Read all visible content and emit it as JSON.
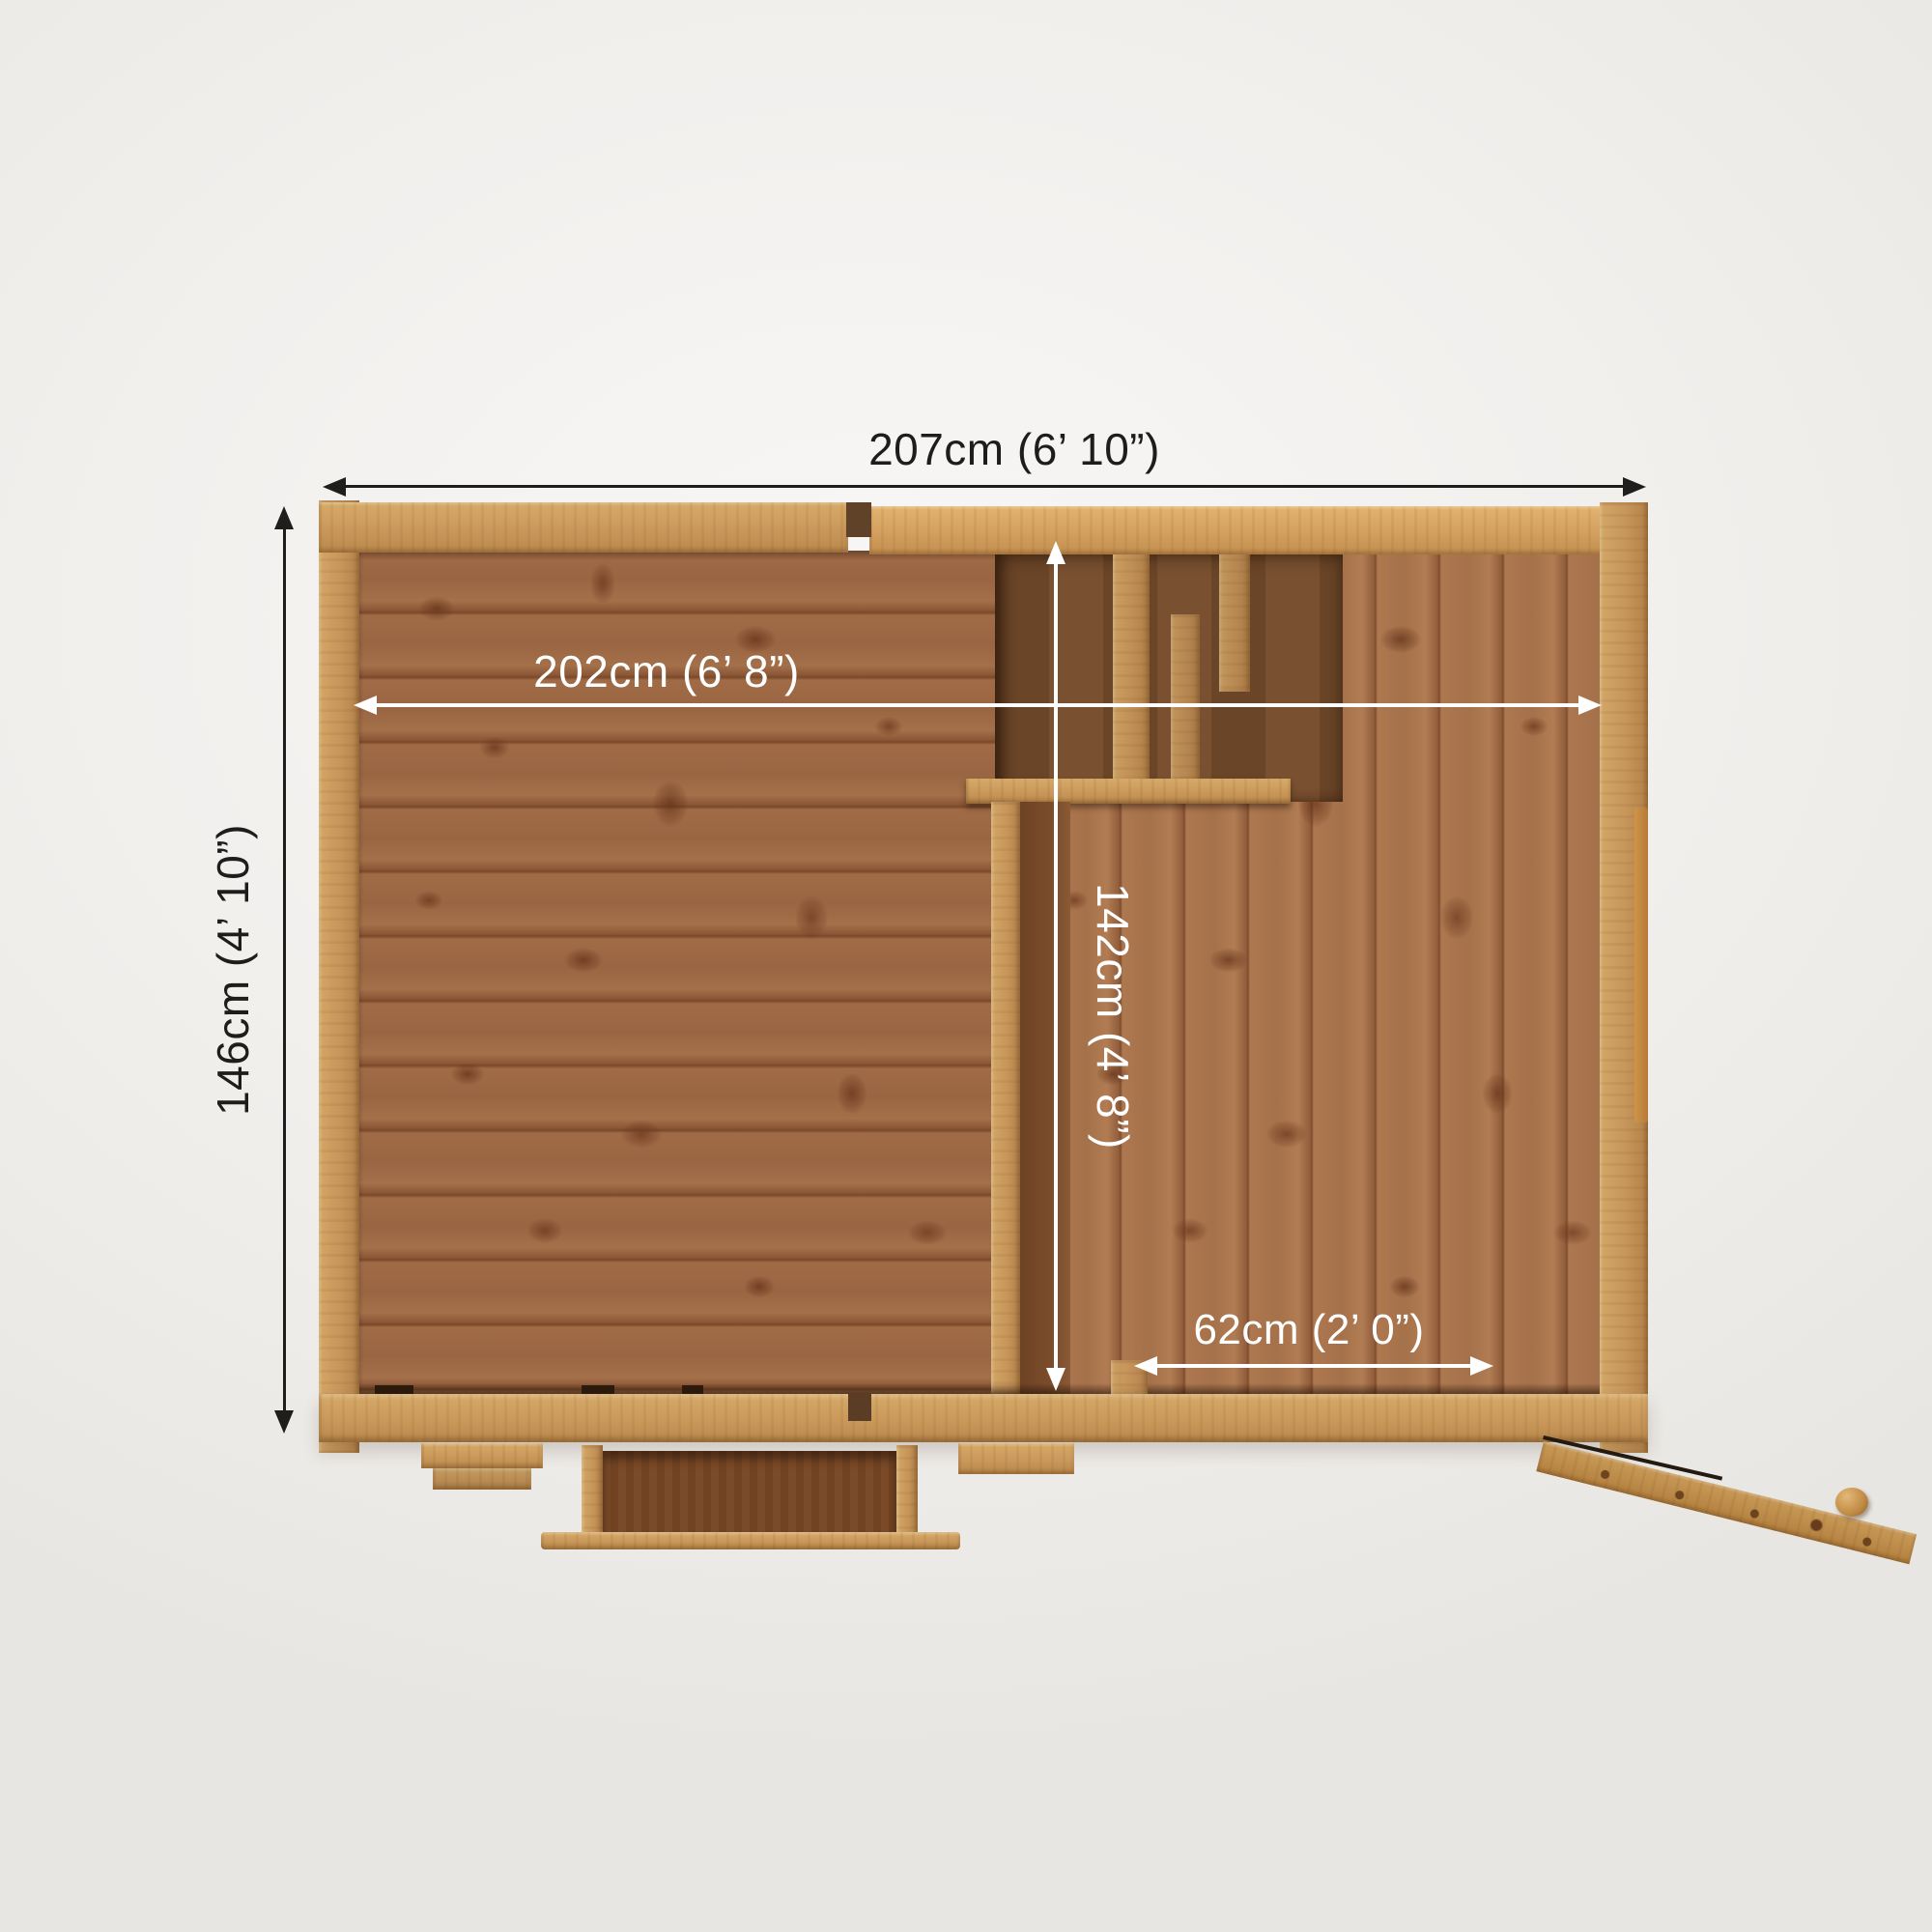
{
  "diagram": {
    "type": "shed-top-view-floor-plan",
    "dimensions": {
      "overall_width": "207cm (6’ 10”)",
      "overall_depth": "146cm (4’ 10”)",
      "internal_width": "202cm (6’ 8”)",
      "internal_depth": "142cm (4’ 8”)",
      "side_storage_width": "62cm (2’ 0”)"
    },
    "palette": {
      "background": "#f1efec",
      "frame_timber": "#c9995a",
      "main_floor_planks": "#9c6743",
      "side_floor_planks": "#a9734c",
      "recess_shadow": "#6e482a",
      "dimension_text_dark": "#1d1d1b",
      "dimension_text_light": "#ffffff"
    }
  }
}
